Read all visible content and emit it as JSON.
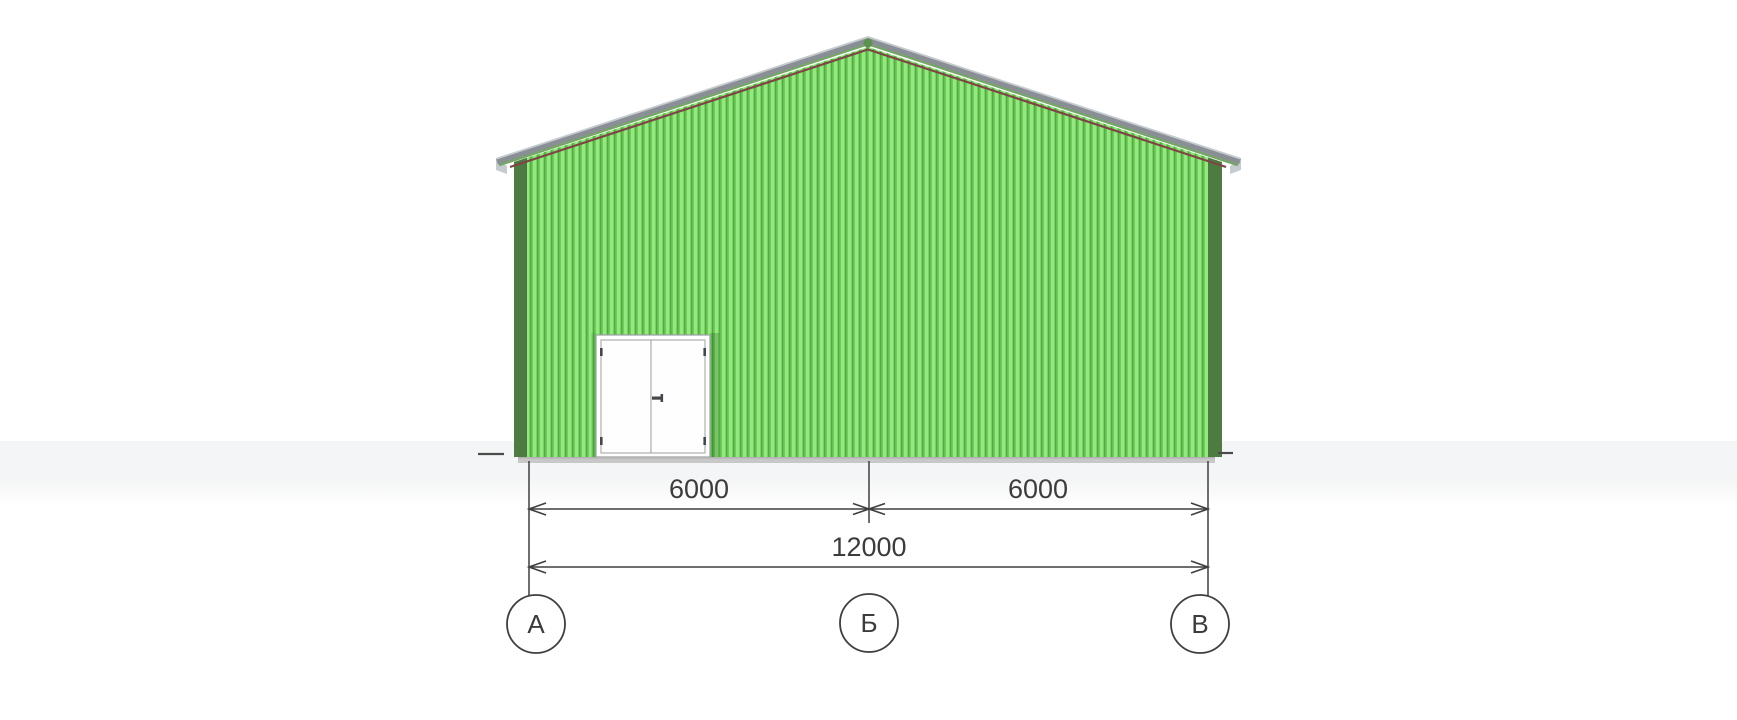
{
  "elevation": {
    "axis_labels": {
      "a": "А",
      "b": "Б",
      "v": "В"
    },
    "dimensions": {
      "bay_left": "6000",
      "bay_right": "6000",
      "total": "12000"
    }
  },
  "colors": {
    "siding-light": "#95e77f",
    "siding-mid": "#6fce5a",
    "siding-dark": "#54aa44",
    "corner-trim": "#4e7b41",
    "roof-gray": "#898f95",
    "roof-gray-light": "#c6cbcf",
    "roof-green": "#74a765",
    "roof-maroon": "#7e4545",
    "ridge-cap": "#5e9150",
    "base-strip": "#c8c8c8",
    "base-strip-dark": "#b3b3b3",
    "door-white": "#fefefe",
    "door-frame-line": "#9aa0a4",
    "door-leaf-line": "#a8a8a8",
    "door-hardware": "#44474b",
    "door-shadow": "rgba(20,70,10,0.22)",
    "dim-line": "#3f3f3f",
    "dim-text": "#3c3c3c",
    "ground-mark": "#4b4b4b",
    "ground-band": "#f4f5f6"
  }
}
